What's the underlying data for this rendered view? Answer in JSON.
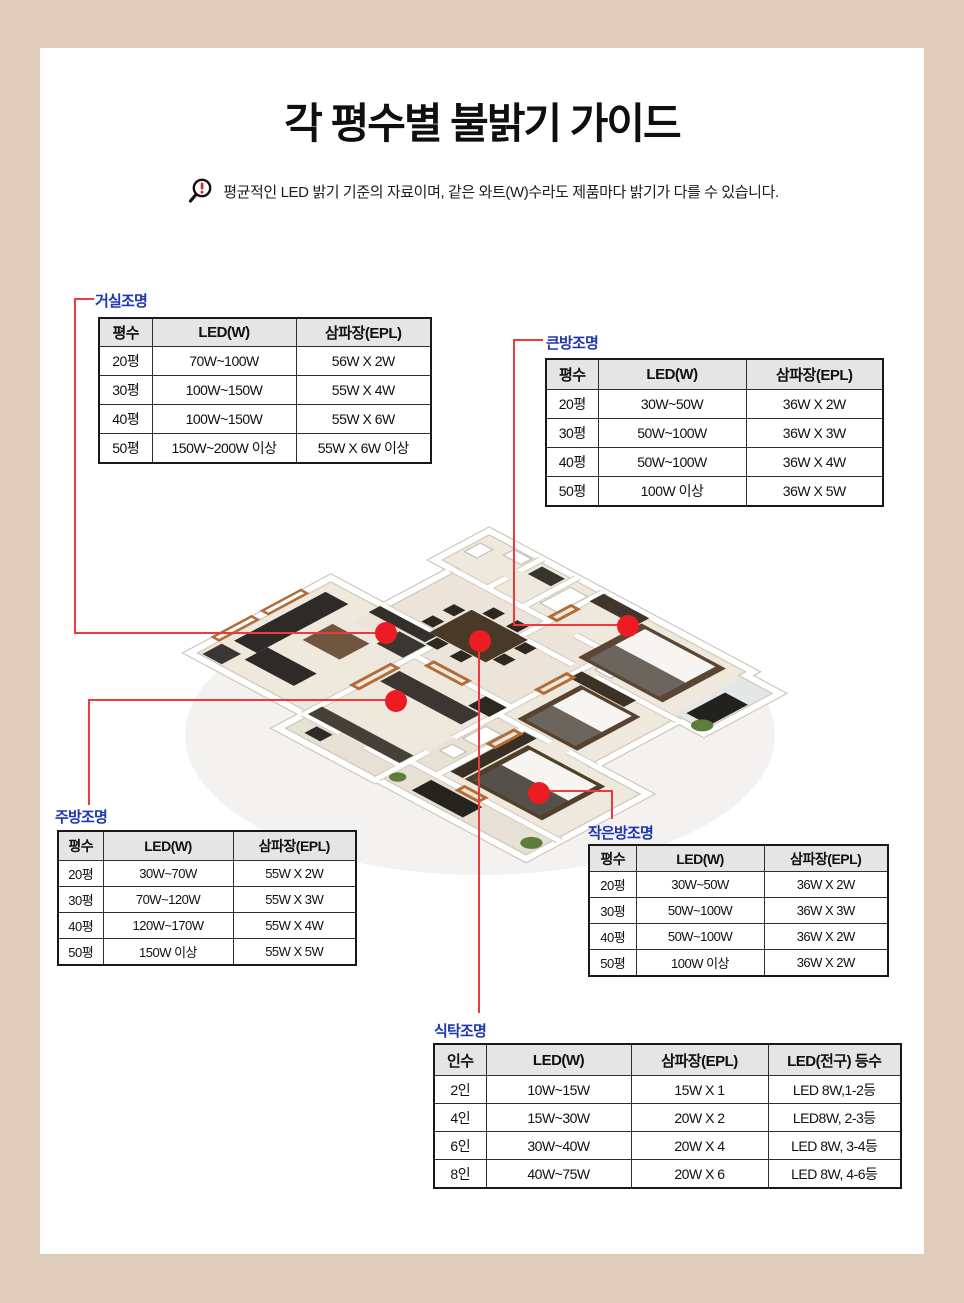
{
  "page": {
    "title": "각 평수별 불밝기 가이드",
    "notice": "평균적인 LED 밝기 기준의 자료이며, 같은 와트(W)수라도 제품마다 밝기가 다를 수 있습니다.",
    "notice_icon": "magnifier-exclamation-icon",
    "colors": {
      "frame_beige": "#e0ccba",
      "label_blue": "#2036b0",
      "connector_red": "#ee3a3e",
      "marker_red": "#ed1c24",
      "table_header_gray": "#e5e5e5",
      "table_border": "#2e2e2e"
    }
  },
  "tables": {
    "living": {
      "label": "거실조명",
      "headers": [
        "평수",
        "LED(W)",
        "삼파장(EPL)"
      ],
      "rows": [
        [
          "20평",
          "70W~100W",
          "56W X 2W"
        ],
        [
          "30평",
          "100W~150W",
          "55W X 4W"
        ],
        [
          "40평",
          "100W~150W",
          "55W X 6W"
        ],
        [
          "50평",
          "150W~200W 이상",
          "55W X 6W 이상"
        ]
      ]
    },
    "big_room": {
      "label": "큰방조명",
      "headers": [
        "평수",
        "LED(W)",
        "삼파장(EPL)"
      ],
      "rows": [
        [
          "20평",
          "30W~50W",
          "36W X 2W"
        ],
        [
          "30평",
          "50W~100W",
          "36W X 3W"
        ],
        [
          "40평",
          "50W~100W",
          "36W X 4W"
        ],
        [
          "50평",
          "100W 이상",
          "36W X 5W"
        ]
      ]
    },
    "kitchen": {
      "label": "주방조명",
      "headers": [
        "평수",
        "LED(W)",
        "삼파장(EPL)"
      ],
      "rows": [
        [
          "20평",
          "30W~70W",
          "55W X 2W"
        ],
        [
          "30평",
          "70W~120W",
          "55W X 3W"
        ],
        [
          "40평",
          "120W~170W",
          "55W X 4W"
        ],
        [
          "50평",
          "150W 이상",
          "55W X 5W"
        ]
      ]
    },
    "small_room": {
      "label": "작은방조명",
      "headers": [
        "평수",
        "LED(W)",
        "삼파장(EPL)"
      ],
      "rows": [
        [
          "20평",
          "30W~50W",
          "36W X 2W"
        ],
        [
          "30평",
          "50W~100W",
          "36W X 3W"
        ],
        [
          "40평",
          "50W~100W",
          "36W X 2W"
        ],
        [
          "50평",
          "100W 이상",
          "36W X 2W"
        ]
      ]
    },
    "dining": {
      "label": "식탁조명",
      "headers": [
        "인수",
        "LED(W)",
        "삼파장(EPL)",
        "LED(전구) 등수"
      ],
      "rows": [
        [
          "2인",
          "10W~15W",
          "15W X 1",
          "LED 8W,1-2등"
        ],
        [
          "4인",
          "15W~30W",
          "20W X 2",
          "LED8W, 2-3등"
        ],
        [
          "6인",
          "30W~40W",
          "20W X 4",
          "LED 8W, 3-4등"
        ],
        [
          "8인",
          "40W~75W",
          "20W X 6",
          "LED 8W, 4-6등"
        ]
      ]
    }
  }
}
